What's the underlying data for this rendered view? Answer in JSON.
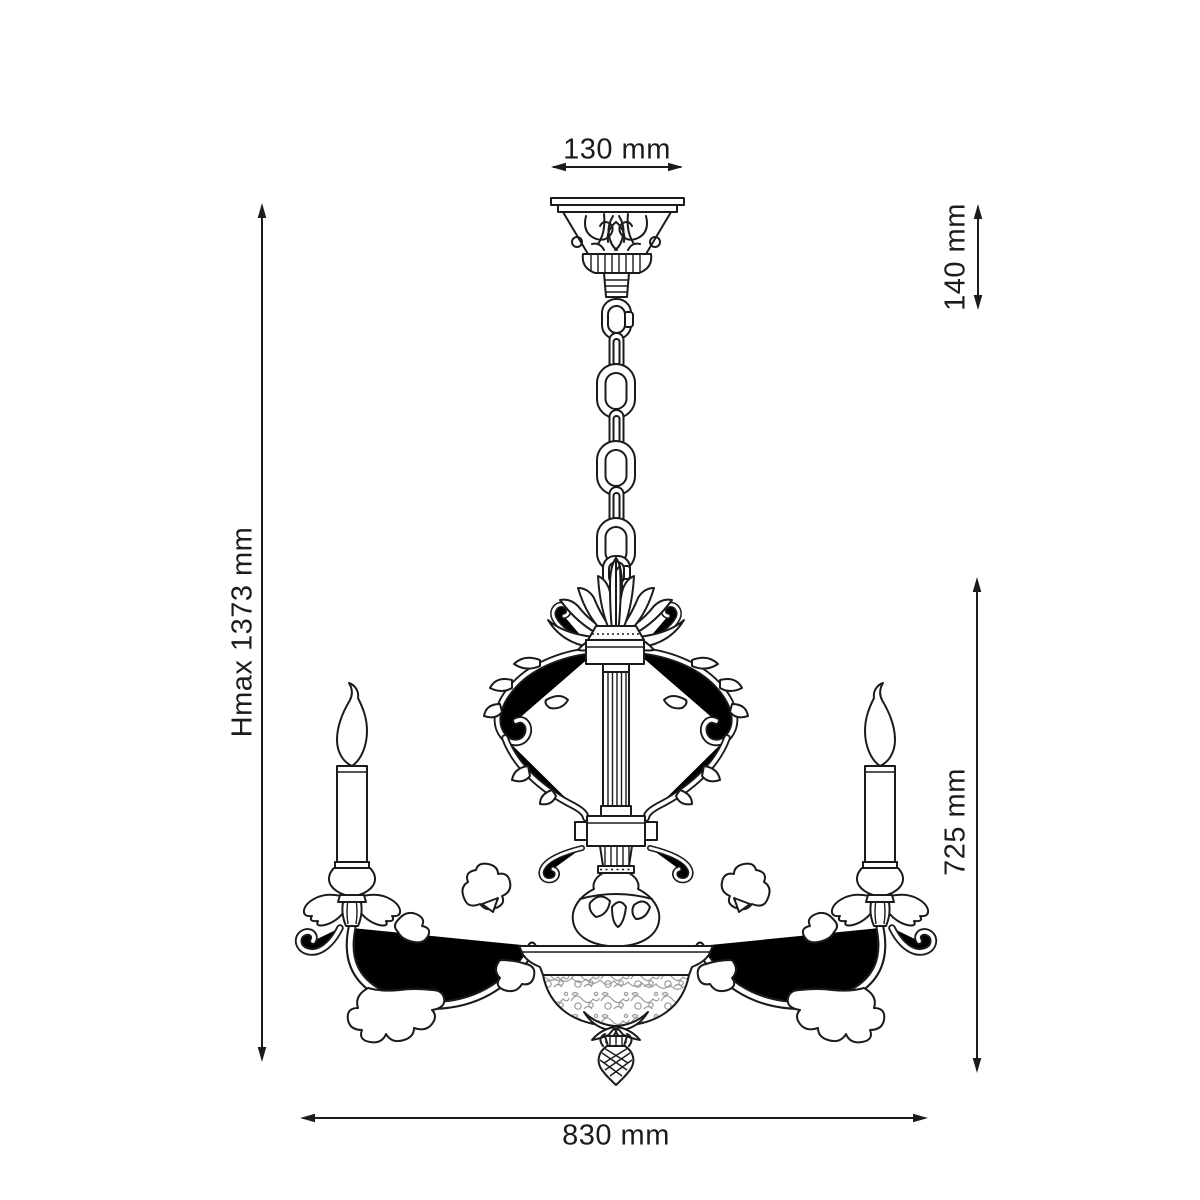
{
  "page": {
    "background": "#ffffff",
    "line_color": "#1b1b1b",
    "label_color": "#1c1c1c",
    "etched_glass_color": "#a6a6a6"
  },
  "drawing": {
    "title": "Chandelier technical dimension drawing",
    "object": "classic chandelier with ornate ceiling canopy, suspension chain, scrolled lyre body, two candle arms and etched glass bowl with finial"
  },
  "dimensions": {
    "canopy_width": {
      "label": "130 mm",
      "orientation": "horizontal",
      "position": "top"
    },
    "suspension_height": {
      "label": "140 mm",
      "orientation": "vertical",
      "position": "top-right"
    },
    "max_height": {
      "label": "Hmax 1373 mm",
      "orientation": "vertical",
      "position": "left"
    },
    "body_height": {
      "label": "725 mm",
      "orientation": "vertical",
      "position": "right"
    },
    "total_width": {
      "label": "830 mm",
      "orientation": "horizontal",
      "position": "bottom"
    }
  }
}
